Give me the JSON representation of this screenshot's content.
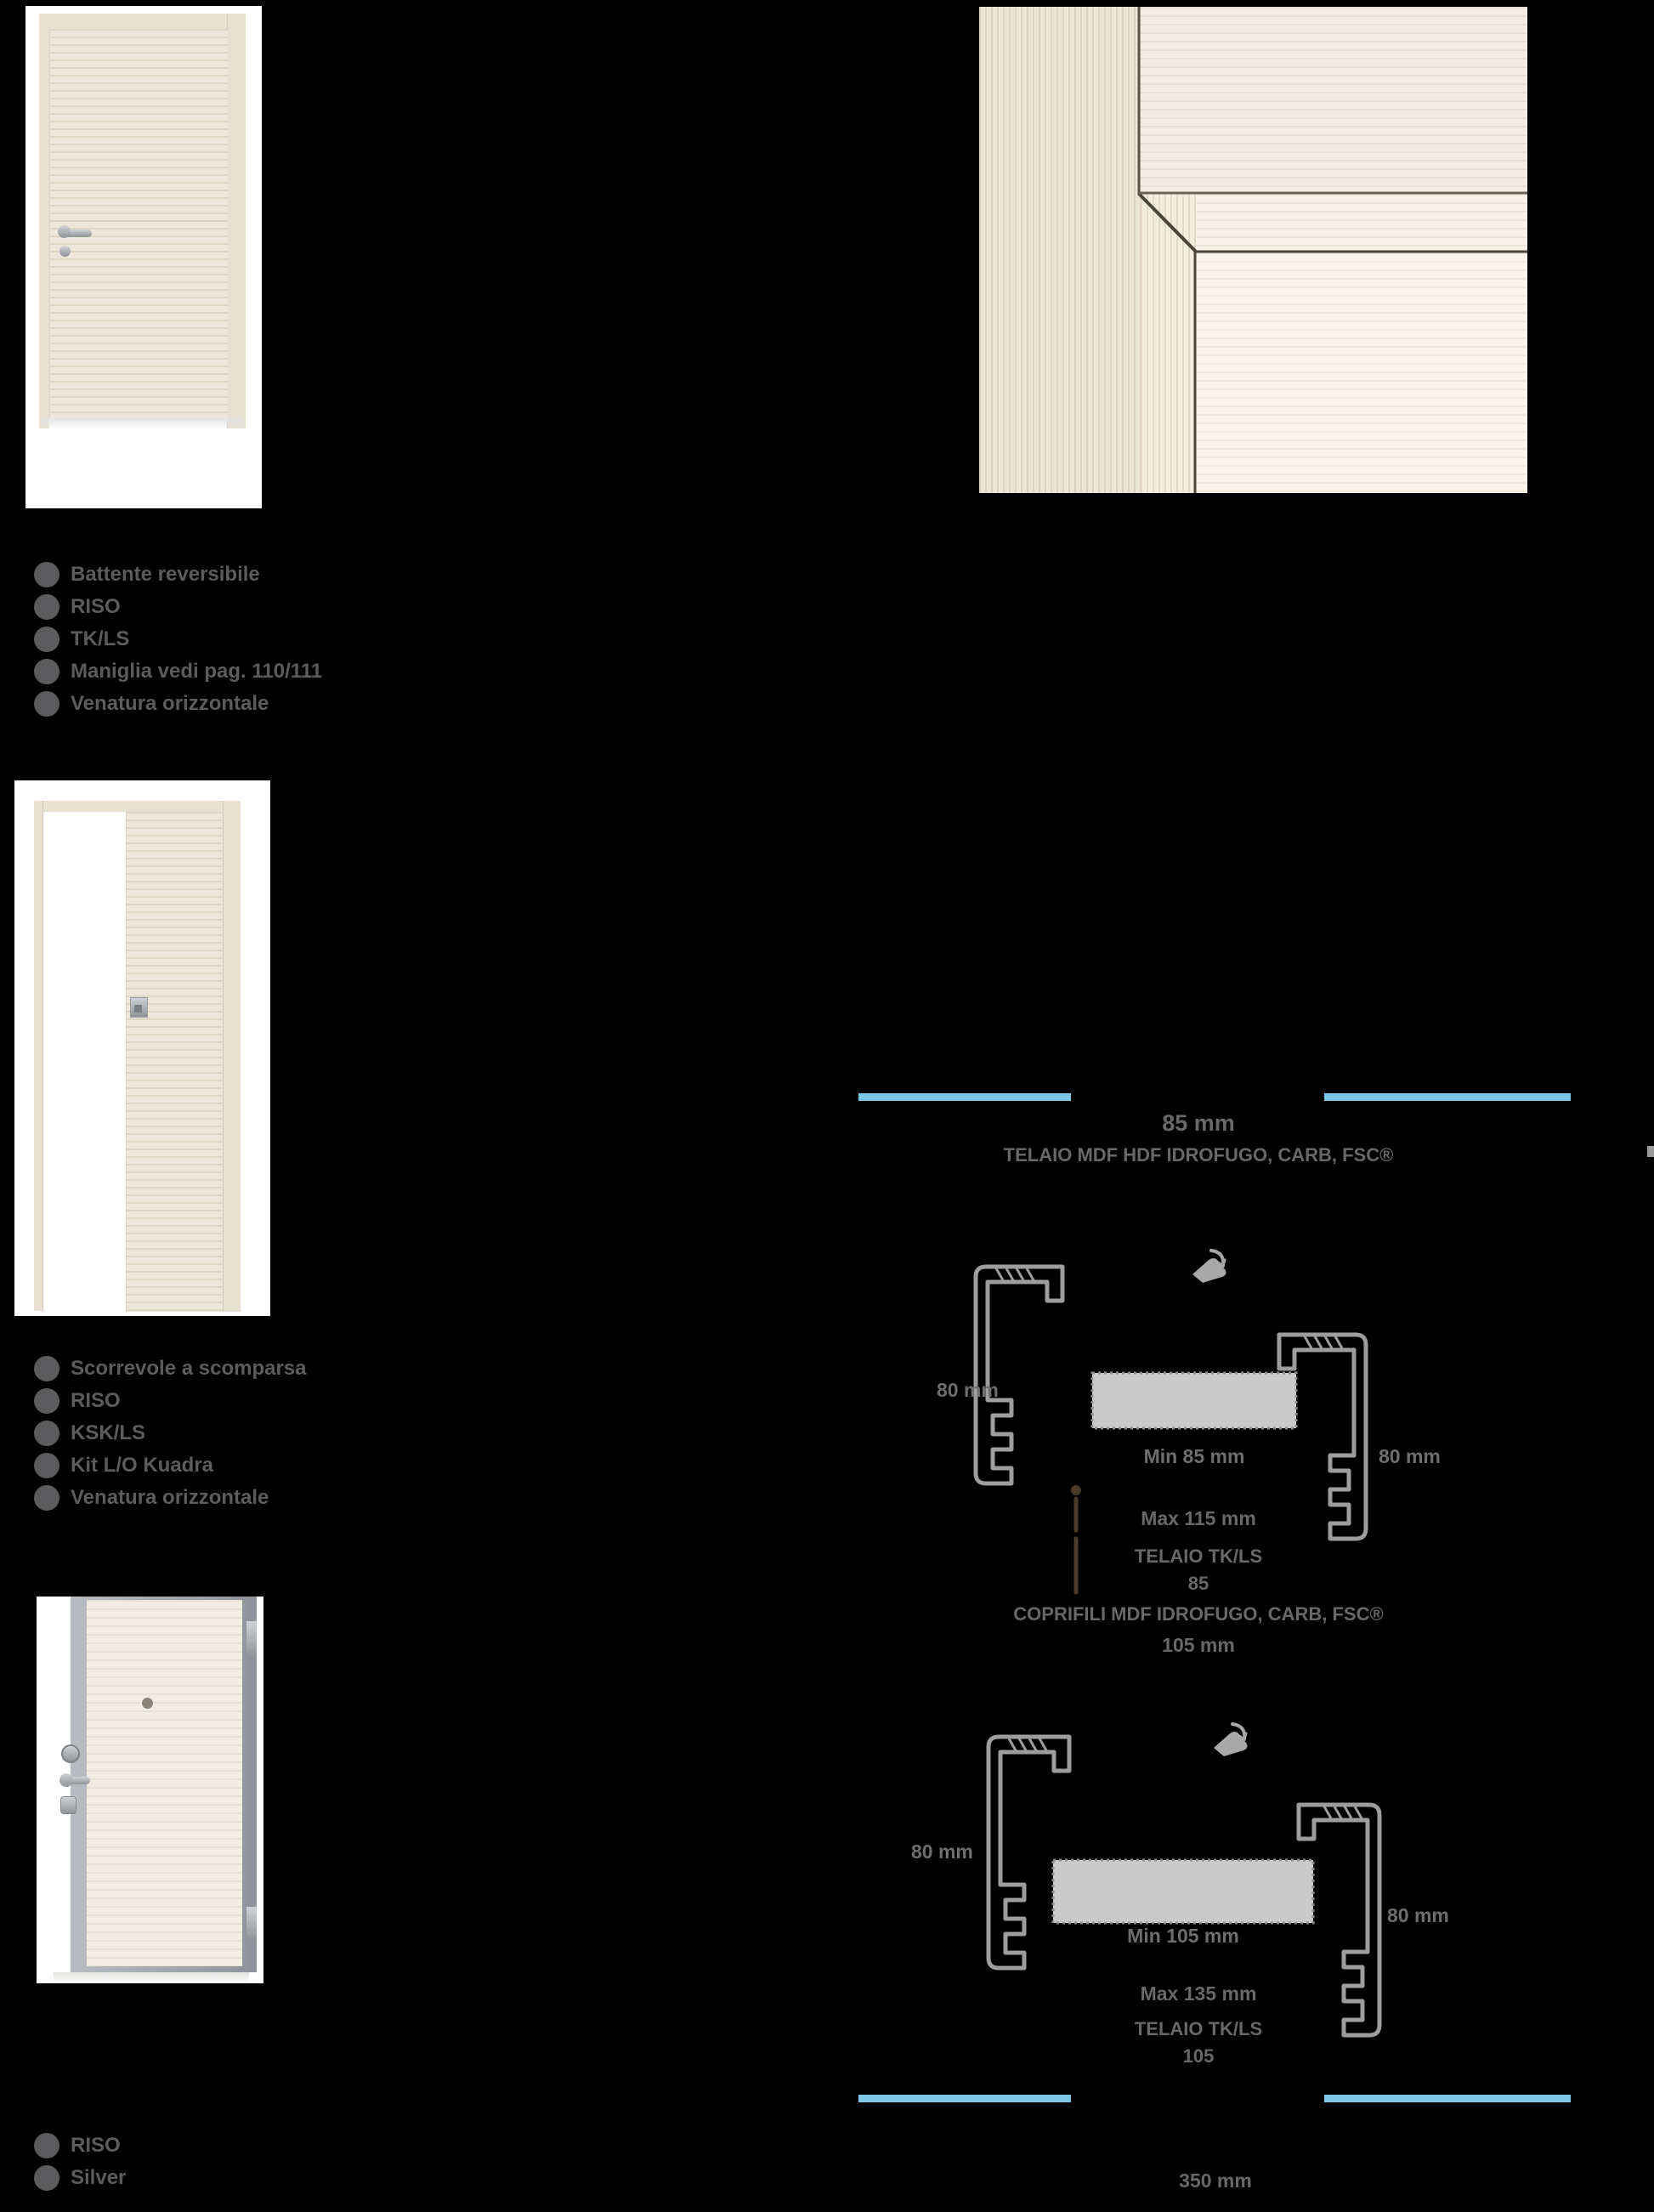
{
  "page": {
    "background": "#000000"
  },
  "products": [
    {
      "name": "porta battente",
      "bullets": [
        "Battente reversibile",
        "RISO",
        "TK/LS",
        "Maniglia vedi pag. 110/111",
        "Venatura orizzontale"
      ]
    },
    {
      "name": "porta scorrevole",
      "bullets": [
        "Scorrevole a scomparsa",
        "RISO",
        "KSK/LS",
        "Kit L/O Kuadra",
        "Venatura orizzontale"
      ]
    },
    {
      "name": "porta blindata",
      "bullets": [
        "RISO",
        "Silver"
      ]
    }
  ],
  "tech": {
    "header": {
      "thickness": "85 mm",
      "frame_spec": "TELAIO MDF HDF IDROFUGO, CARB, FSC®"
    },
    "diagram1": {
      "left_dim": "80 mm",
      "right_dim": "80 mm",
      "wall_min": "Min 85 mm",
      "wall_max": "Max 115 mm",
      "frame_name": "TELAIO TK/LS",
      "frame_size": "85",
      "casing_spec": "COPRIFILI MDF IDROFUGO, CARB, FSC®",
      "casing_size": "105 mm"
    },
    "diagram2": {
      "left_dim": "80 mm",
      "right_dim": "80 mm",
      "wall_min": "Min 105 mm",
      "wall_max": "Max 135 mm",
      "frame_name": "TELAIO TK/LS",
      "frame_size": "105"
    },
    "footer_dim": "350 mm"
  },
  "colors": {
    "accent_blue": "#7cc6e6",
    "text_gray": "#5c5c5e",
    "profile_gray": "#9d9d9d",
    "wall_gray": "#cacaca",
    "leader_brown": "#4a3a28"
  }
}
